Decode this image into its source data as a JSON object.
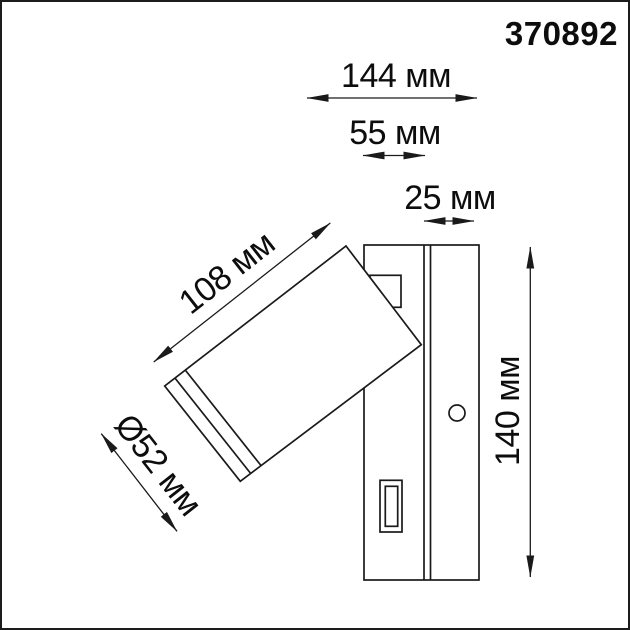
{
  "product_code": "370892",
  "colors": {
    "line": "#1a1a1a",
    "background": "#ffffff"
  },
  "figure": {
    "type": "technical-dimension-drawing",
    "subject": "wall-mounted-spot-lamp-side-view"
  },
  "dimensions": {
    "total_depth": {
      "label": "144 мм",
      "value_mm": 144
    },
    "body_depth": {
      "label": "55 мм",
      "value_mm": 55
    },
    "plate_depth": {
      "label": "25 мм",
      "value_mm": 25
    },
    "head_length": {
      "label": "108 мм",
      "value_mm": 108
    },
    "head_diameter": {
      "label": "Ø52 мм",
      "value_mm": 52
    },
    "height": {
      "label": "140 мм",
      "value_mm": 140
    }
  }
}
